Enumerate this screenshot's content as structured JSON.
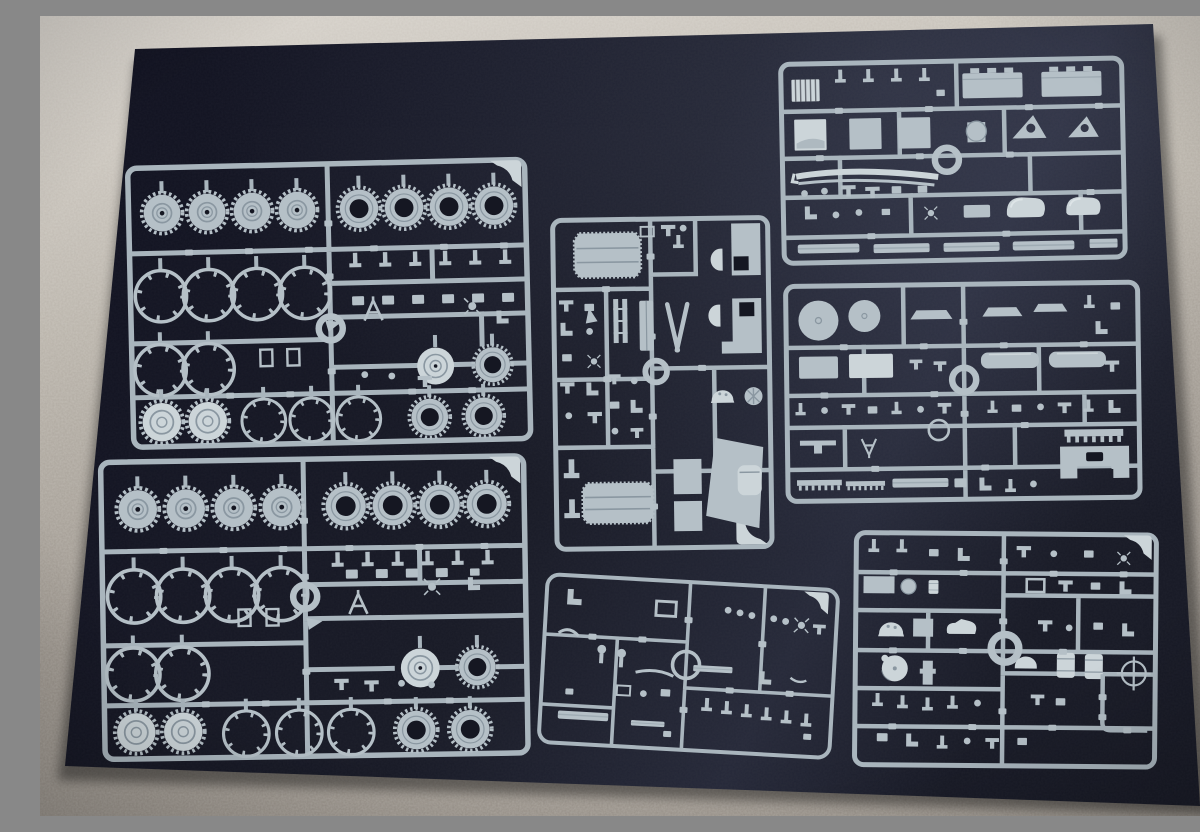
{
  "scene": {
    "subject": "Seven unassembled light-grey plastic scale-model sprues (parts trees) laid out on a dark blue-black board photographed on beige carpet",
    "sprue_count": 7,
    "sprues": {
      "a": {
        "label": "wheel and tire sprue, upper left"
      },
      "b": {
        "label": "wheel and tire sprue, lower left (duplicate of upper)"
      },
      "c": {
        "label": "hull plates and panel sprue, center"
      },
      "d": {
        "label": "sparse small-fittings sprue, bottom center"
      },
      "e": {
        "label": "boxes and fender sprue, top right"
      },
      "f": {
        "label": "chassis and stowage sprue, middle right"
      },
      "g": {
        "label": "fine-detail sprue, bottom right"
      }
    }
  },
  "colors": {
    "carpet_light": "#d6d1ca",
    "carpet_mid": "#b8b2a9",
    "carpet_dark": "#99928a",
    "mat_dark": "#111221",
    "mat_mid": "#181a26",
    "mat_light": "#262939",
    "mat_hole": "#151722",
    "plastic": "#b5c0c7",
    "plastic_bright": "#ccd5d9",
    "plastic_shade": "#8a97a1",
    "runner": "#a9b5bd"
  },
  "wheels": {
    "a": {
      "rows": [
        {
          "type": "gear",
          "cy": 48,
          "r": 21,
          "cx": [
            36,
            81,
            126,
            171
          ]
        },
        {
          "type": "tire",
          "cy": 48,
          "r": 22,
          "cx": [
            233,
            278,
            323,
            368
          ]
        },
        {
          "type": "ring",
          "cy": 131,
          "r": 27,
          "cx": [
            33,
            81,
            129,
            177
          ]
        },
        {
          "type": "ring",
          "cy": 205,
          "r": 27,
          "cx": [
            31,
            79
          ]
        },
        {
          "type": "hub",
          "cy": 207,
          "r": 20,
          "cx": [
            306
          ]
        },
        {
          "type": "tire",
          "cy": 207,
          "r": 20,
          "cx": [
            363
          ]
        },
        {
          "type": "hubtooth",
          "cy": 257,
          "r": 22,
          "cx": [
            31,
            77
          ]
        },
        {
          "type": "ring",
          "cy": 258,
          "r": 23,
          "cx": [
            133,
            181,
            228
          ]
        },
        {
          "type": "tire",
          "cy": 258,
          "r": 21,
          "cx": [
            299,
            353
          ]
        }
      ]
    },
    "b": {
      "rows": [
        {
          "type": "gear",
          "cy": 50,
          "r": 22,
          "cx": [
            39,
            87,
            135,
            183
          ]
        },
        {
          "type": "tire",
          "cy": 50,
          "r": 23,
          "cx": [
            247,
            294,
            341,
            388
          ]
        },
        {
          "type": "ring",
          "cy": 137,
          "r": 28,
          "cx": [
            34,
            83,
            132,
            181
          ]
        },
        {
          "type": "ring",
          "cy": 215,
          "r": 28,
          "cx": [
            32,
            81
          ]
        },
        {
          "type": "hub",
          "cy": 213,
          "r": 21,
          "cx": [
            319
          ]
        },
        {
          "type": "tire",
          "cy": 213,
          "r": 21,
          "cx": [
            376
          ]
        },
        {
          "type": "hubtooth",
          "cy": 273,
          "r": 22,
          "cx": [
            34,
            81
          ]
        },
        {
          "type": "ring",
          "cy": 276,
          "r": 24,
          "cx": [
            144,
            197,
            249
          ]
        },
        {
          "type": "tire",
          "cy": 275,
          "r": 22,
          "cx": [
            314,
            368
          ]
        }
      ]
    }
  }
}
